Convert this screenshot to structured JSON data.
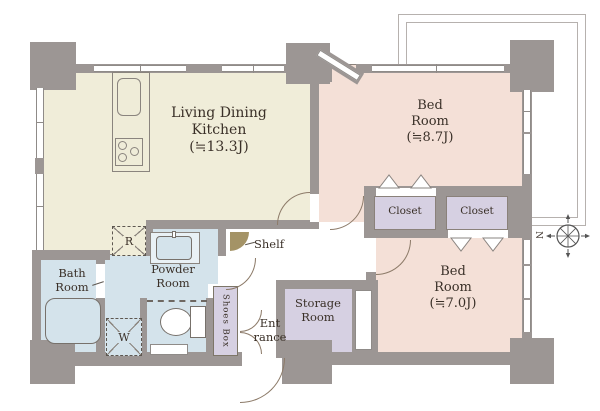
{
  "plan": {
    "rooms": {
      "ldk": {
        "line1": "Living Dining",
        "line2": "Kitchen",
        "area": "(≒13.3J)"
      },
      "bedroom1": {
        "line1": "Bed",
        "line2": "Room",
        "area": "(≒8.7J)"
      },
      "bedroom2": {
        "line1": "Bed",
        "line2": "Room",
        "area": "(≒7.0J)"
      },
      "closet1": {
        "label": "Closet"
      },
      "closet2": {
        "label": "Closet"
      },
      "bath": {
        "line1": "Bath",
        "line2": "Room"
      },
      "powder": {
        "line1": "Powder",
        "line2": "Room"
      },
      "storage": {
        "line1": "Storage",
        "line2": "Room"
      },
      "entrance": {
        "line1": "Ent",
        "line2": "rance"
      },
      "shoes_box": {
        "label": "Shoes Box"
      },
      "shelf": {
        "label": "Shelf"
      }
    },
    "markers": {
      "refrigerator": "R",
      "washing_machine": "W",
      "compass_north": "N"
    },
    "colors": {
      "wall": "#9c9694",
      "ldk_floor": "#f0edd9",
      "bedroom_floor": "#f4e0d7",
      "closet_floor": "#d6d0e2",
      "wet_area_floor": "#d4e3eb",
      "hall_floor": "#ffffff",
      "shelf": "#a49366",
      "text": "#3a3028"
    }
  }
}
